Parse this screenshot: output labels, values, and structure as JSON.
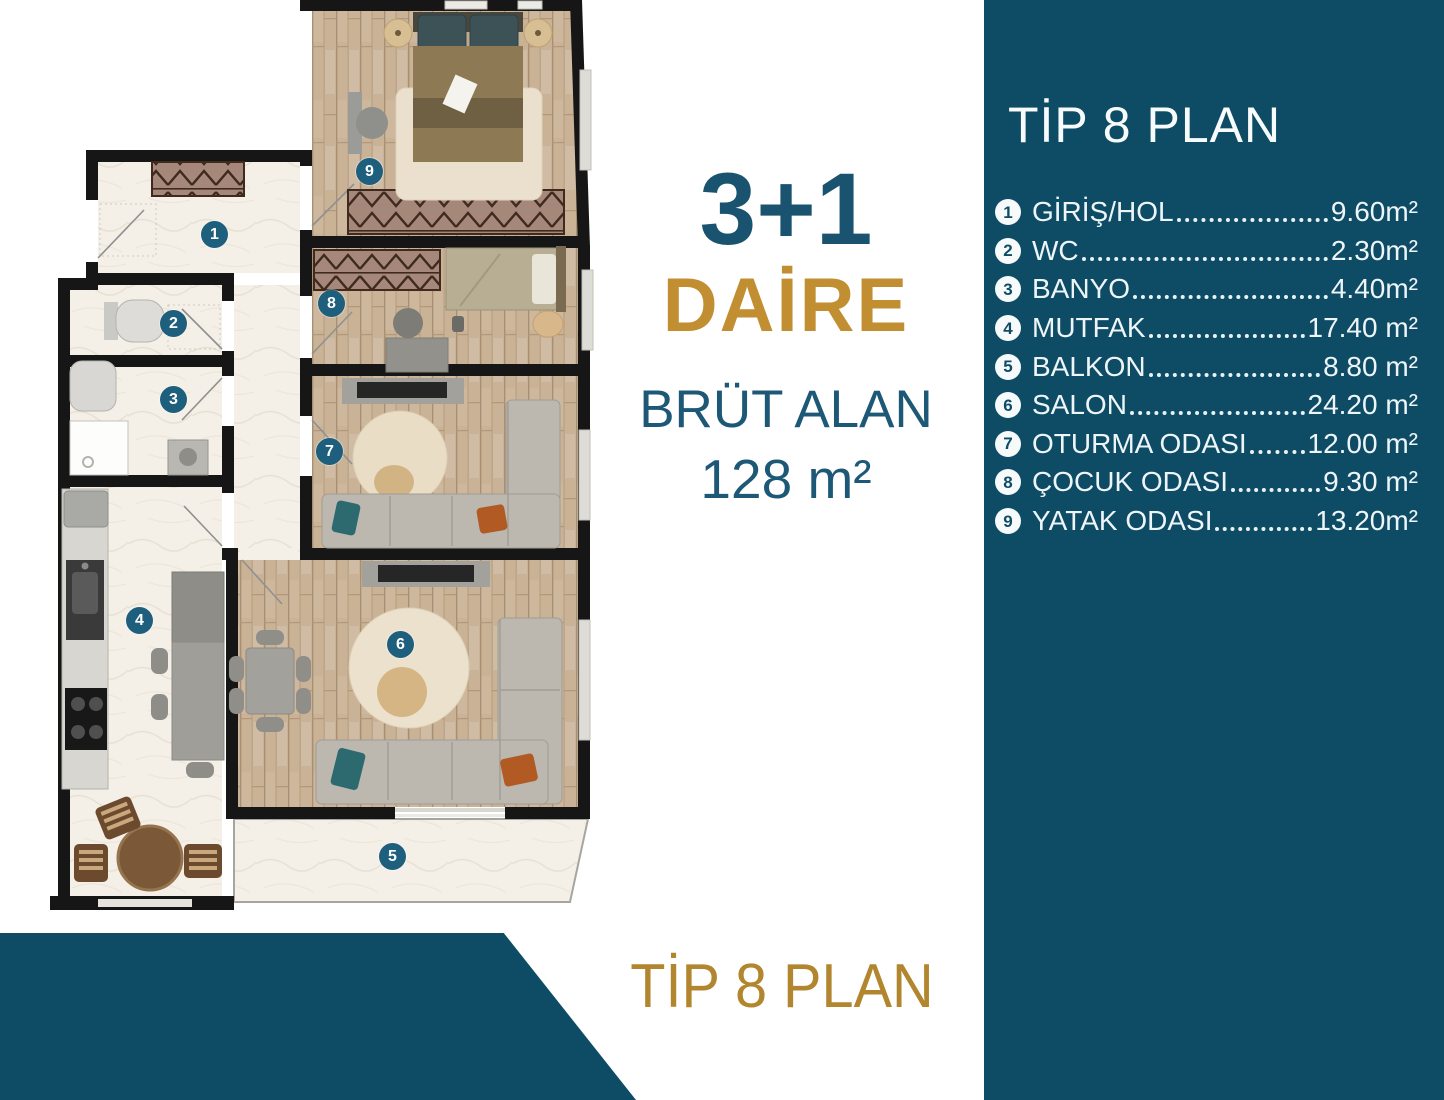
{
  "colors": {
    "sidebar_teal": "#0e4c65",
    "banner_teal": "#0e4c65",
    "plan_badge_teal": "#1d5f7c",
    "info_teal": "#19536f",
    "gold_daire": "#c28e32",
    "gold_banner": "#b1862e",
    "wall_black": "#161616",
    "wood_floor": "#c9b296",
    "marble_floor": "#f4efe7"
  },
  "sidebar": {
    "title": "TİP 8 PLAN",
    "items": [
      {
        "num": "1",
        "label": "GİRİŞ/HOL",
        "value": "9.60m²"
      },
      {
        "num": "2",
        "label": "WC",
        "value": "2.30m²"
      },
      {
        "num": "3",
        "label": "BANYO",
        "value": "4.40m²"
      },
      {
        "num": "4",
        "label": "MUTFAK",
        "value": "17.40 m²"
      },
      {
        "num": "5",
        "label": "BALKON",
        "value": "8.80 m²"
      },
      {
        "num": "6",
        "label": "SALON",
        "value": "24.20 m²"
      },
      {
        "num": "7",
        "label": "OTURMA ODASI",
        "value": "12.00 m²"
      },
      {
        "num": "8",
        "label": "ÇOCUK ODASI",
        "value": "9.30 m²"
      },
      {
        "num": "9",
        "label": "YATAK ODASI",
        "value": "13.20m²"
      }
    ]
  },
  "info": {
    "type": "3+1",
    "unit": "DAİRE",
    "area_label": "BRÜT ALAN",
    "area_value": "128 m²"
  },
  "banner": {
    "title": "TİP 8 PLAN"
  },
  "plan": {
    "badges": [
      {
        "number": "1"
      },
      {
        "number": "2"
      },
      {
        "number": "3"
      },
      {
        "number": "4"
      },
      {
        "number": "5"
      },
      {
        "number": "6"
      },
      {
        "number": "7"
      },
      {
        "number": "8"
      },
      {
        "number": "9"
      }
    ]
  }
}
